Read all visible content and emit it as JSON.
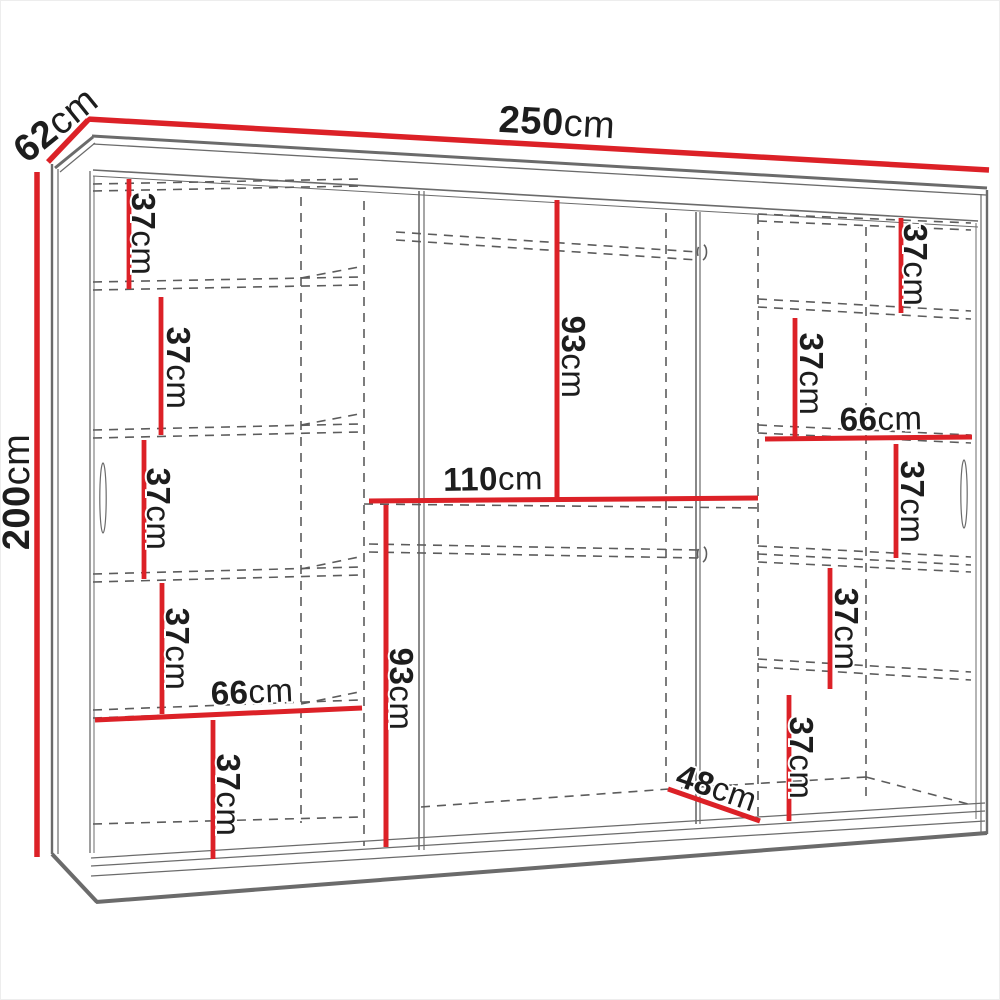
{
  "figure": {
    "kind": "wardrobe-dimension-diagram",
    "background": "#ffffff"
  },
  "colors": {
    "dimension_red": "#dc2127",
    "structure_gray": "#6b6b6b",
    "dashed_gray": "#5c5c5c",
    "text_dark": "#1d1d1d"
  },
  "labels": [
    {
      "id": "width-250",
      "value": "250",
      "unit": "cm"
    },
    {
      "id": "depth-62",
      "value": "62",
      "unit": "cm"
    },
    {
      "id": "height-200",
      "value": "200",
      "unit": "cm"
    },
    {
      "id": "left-shelf-1",
      "value": "37",
      "unit": "cm"
    },
    {
      "id": "left-shelf-2",
      "value": "37",
      "unit": "cm"
    },
    {
      "id": "left-shelf-3",
      "value": "37",
      "unit": "cm"
    },
    {
      "id": "left-shelf-4",
      "value": "37",
      "unit": "cm"
    },
    {
      "id": "left-width-66",
      "value": "66",
      "unit": "cm"
    },
    {
      "id": "left-shelf-5",
      "value": "37",
      "unit": "cm"
    },
    {
      "id": "middle-hang-93",
      "value": "93",
      "unit": "cm"
    },
    {
      "id": "middle-width-110",
      "value": "110",
      "unit": "cm"
    },
    {
      "id": "middle-lower-93",
      "value": "93",
      "unit": "cm"
    },
    {
      "id": "bottom-depth-48",
      "value": "48",
      "unit": "cm"
    },
    {
      "id": "right-shelf-1",
      "value": "37",
      "unit": "cm"
    },
    {
      "id": "right-shelf-2",
      "value": "37",
      "unit": "cm"
    },
    {
      "id": "right-width-66",
      "value": "66",
      "unit": "cm"
    },
    {
      "id": "right-shelf-3",
      "value": "37",
      "unit": "cm"
    },
    {
      "id": "right-shelf-4",
      "value": "37",
      "unit": "cm"
    },
    {
      "id": "right-shelf-5",
      "value": "37",
      "unit": "cm"
    }
  ]
}
